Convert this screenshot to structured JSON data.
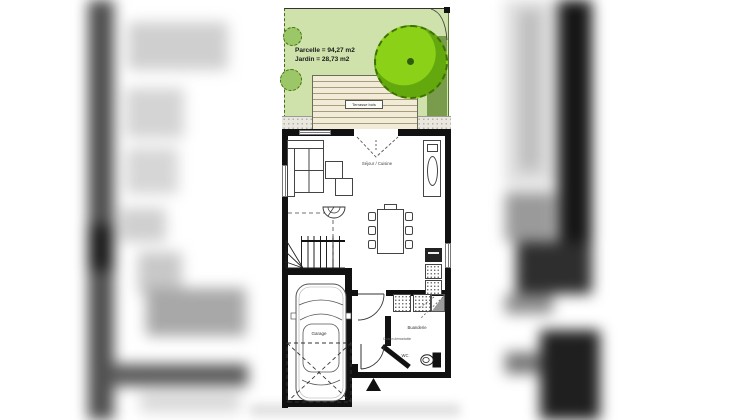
{
  "image_type": "floor-plan photo in listing carousel",
  "garden": {
    "parcelle_label": "Parcelle = 94,27 m2",
    "jardin_label": "Jardin = 28,73 m2",
    "terrace_label": "Terrasse bois"
  },
  "rooms": {
    "living_kitchen": "Séjour / Cuisine",
    "garage": "Garage",
    "laundry": "Buanderie",
    "wc": "WC",
    "partition_note": "Cloison démontable"
  },
  "colors": {
    "garden_green": "#cfe2ab",
    "tree_green": "#85d114",
    "tree_shade_green": "#63a80d",
    "hedge_green": "#789c4b",
    "bush_green": "#9cc768",
    "terrace_cream": "#f2ebd7",
    "wall_black": "#111111",
    "gravel_gray": "#e9e7de"
  }
}
